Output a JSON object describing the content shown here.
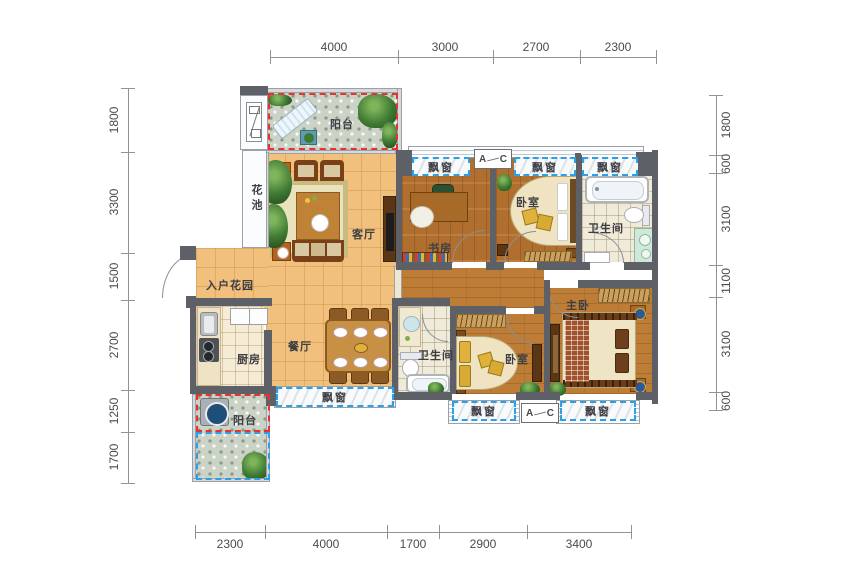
{
  "dimensions": {
    "top": [
      "4000",
      "3000",
      "2700",
      "2300"
    ],
    "bottom": [
      "2300",
      "4000",
      "1700",
      "2900",
      "3400"
    ],
    "left": [
      "1800",
      "3300",
      "1500",
      "2700",
      "1250",
      "1700"
    ],
    "right": [
      "1800",
      "600",
      "3100",
      "1100",
      "3100",
      "600"
    ]
  },
  "rooms": {
    "balcony_top": "阳台",
    "flower_bed": "花池",
    "living_room": "客厅",
    "entry_garden": "入户花园",
    "dining_room": "餐厅",
    "kitchen": "厨房",
    "balcony_bottom": "阳台",
    "study": "书房",
    "bedroom_top": "卧室",
    "bathroom_top": "卫生间",
    "bathroom_mid": "卫生间",
    "bedroom_mid": "卧室",
    "master_bedroom": "主卧"
  },
  "bay_window_label": "飘窗",
  "section_marker": {
    "a": "A",
    "c": "C"
  },
  "colors": {
    "bay_dash": "#2b9fe8",
    "gift_dash": "#e8322b",
    "wall": "#5d6067",
    "tile_floor": "#f1c07d",
    "wood_floor": "#b5752f"
  }
}
